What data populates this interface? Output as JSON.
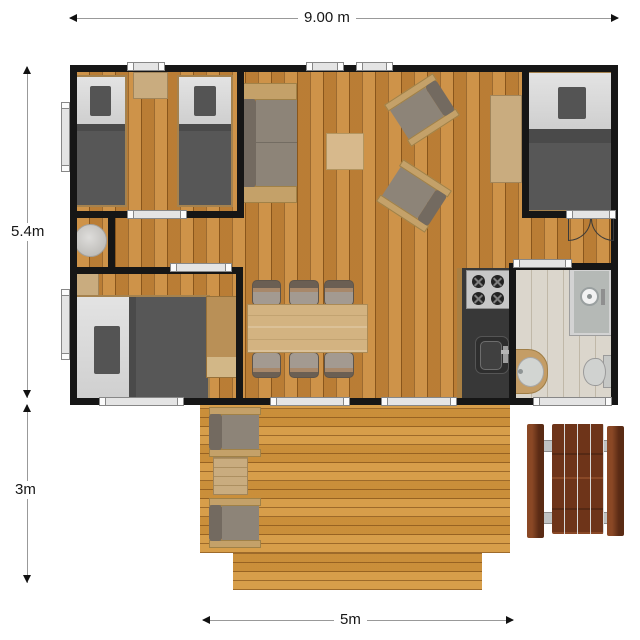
{
  "dimensions": {
    "building_width": "9.00 m",
    "building_depth": "5.4m",
    "terrace_depth": "3m",
    "terrace_width": "5m"
  },
  "palette": {
    "wall": "#161616",
    "interior_floor": "#c8893c",
    "deck_floor": "#d4973f",
    "bathroom_floor": "#dbd6cc",
    "kitchen_counter": "#383838",
    "upholstery_grey": "#8d8478",
    "bedding_dark": "#575757",
    "bedding_light": "#d6d6d6",
    "light_wood": "#c9ac7f",
    "picnic_wood": "#6e3419"
  },
  "inventory": {
    "rooms": [
      "twin bedroom",
      "hallway nook",
      "double bedroom left",
      "double bedroom right",
      "living area",
      "dining area",
      "kitchen",
      "bathroom",
      "terrace"
    ],
    "furniture": [
      "2 single beds",
      "bedside tables",
      "round pouf",
      "2 double beds",
      "sofa",
      "coffee table",
      "2 armchairs",
      "console table",
      "dining table with 6 chairs",
      "hob with 4 burners",
      "kitchen sink",
      "shower",
      "washbasin",
      "toilet",
      "2 terrace chairs",
      "terrace side table",
      "picnic table with 2 benches"
    ]
  }
}
